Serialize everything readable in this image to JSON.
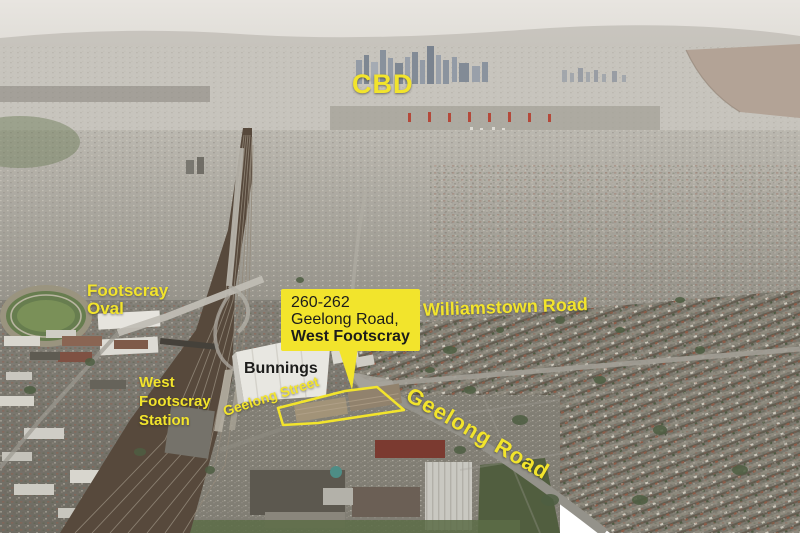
{
  "colors": {
    "highlight": "#f2e42c",
    "text_dark": "#1d1d1b"
  },
  "labels": {
    "cbd": "CBD",
    "oval_line1": "Footscray",
    "oval_line2": "Oval",
    "station_line1": "West",
    "station_line2": "Footscray",
    "station_line3": "Station",
    "bunnings": "Bunnings",
    "williamstown_road": "Williamstown Road",
    "geelong_street": "Geelong Street",
    "geelong_road": "Geelong Road"
  },
  "callout": {
    "line1": "260-262",
    "line2": "Geelong Road,",
    "line3": "West Footscray"
  }
}
